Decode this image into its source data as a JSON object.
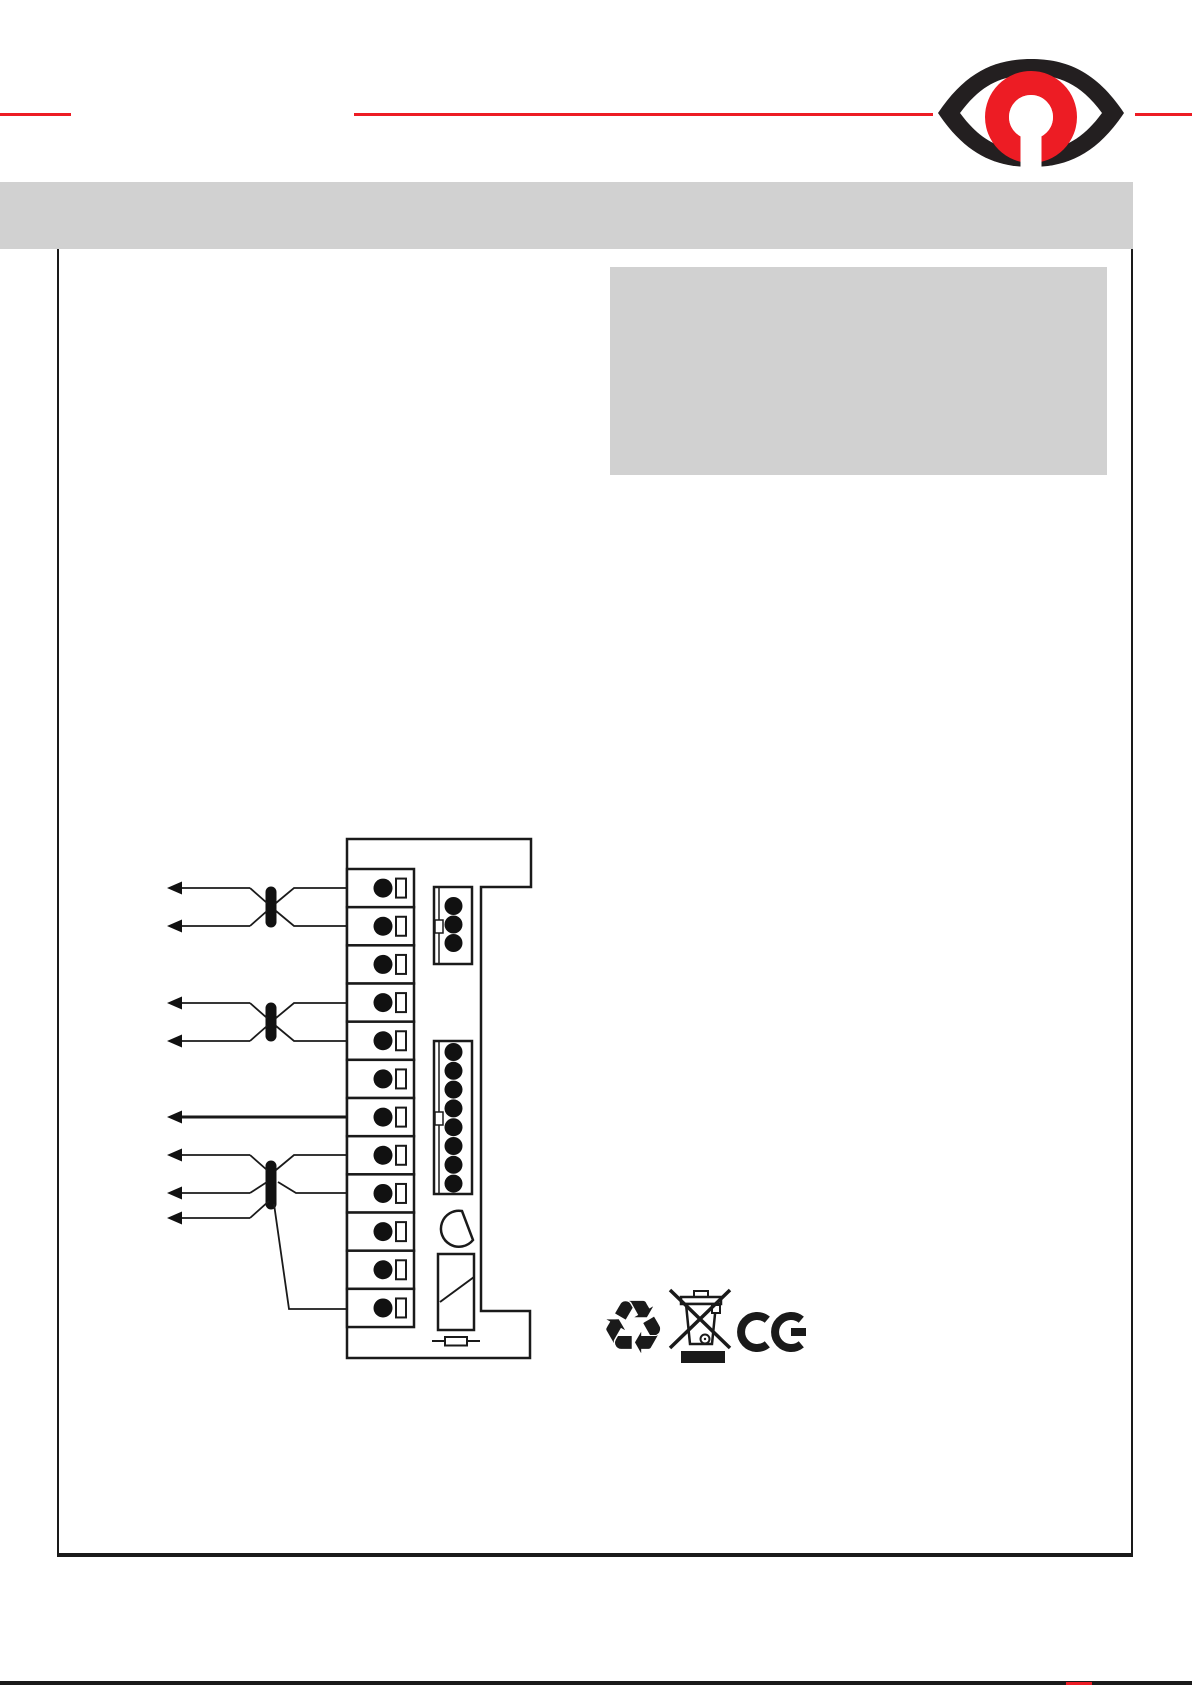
{
  "page": {
    "width": 1192,
    "height": 1685,
    "background": "#ffffff",
    "bottom_rule_color": "#1a1a1a"
  },
  "header": {
    "rule_color": "#ed1c24",
    "rule_segments": [
      [
        0,
        71
      ],
      [
        354,
        933
      ],
      [
        1135,
        1192
      ]
    ],
    "logo": {
      "name": "eye-keyhole-logo",
      "eye_color": "#231f20",
      "omega_color": "#ed1c24",
      "keyhole_color": "#ffffff"
    }
  },
  "title_bar": {
    "color": "#d1d1d1",
    "x": 0,
    "y": 182,
    "w": 1133,
    "h": 67
  },
  "content_box": {
    "x": 57,
    "y": 249,
    "w": 1076,
    "h": 1308
  },
  "info_panel": {
    "color": "#d1d1d1",
    "x": 610,
    "y": 267,
    "w": 497,
    "h": 208
  },
  "diagram": {
    "stroke_color": "#1a1a1a",
    "module_outline": "M347,839 H531 V887 H481 V1311 H530 V1358 H347 Z",
    "terminals": {
      "count": 12,
      "x": 347,
      "width": 67,
      "top": 869,
      "cell_height": 38.17,
      "circle_cx": 383,
      "circle_r": 9.5,
      "slot_x": 396,
      "slot_w": 10,
      "slot_h": 19
    },
    "connectors": [
      {
        "name": "3-pin-connector",
        "x": 434,
        "y": 887,
        "w": 38,
        "h": 77,
        "pins": 3,
        "pin_cx": 453.5,
        "pin_start": 19,
        "pin_step": 18.5,
        "pin_r": 9,
        "notch_dy": 33
      },
      {
        "name": "8-pin-connector",
        "x": 434,
        "y": 1041,
        "w": 38,
        "h": 153,
        "pins": 8,
        "pin_cx": 453.5,
        "pin_start": 11,
        "pin_step": 18.8,
        "pin_r": 9,
        "notch_dy": 71
      }
    ],
    "twists": [
      {
        "x": 271,
        "y1": 892,
        "y2": 922
      },
      {
        "x": 271,
        "y1": 1008,
        "y2": 1036
      },
      {
        "x": 271,
        "y1": 1166,
        "y2": 1204
      }
    ],
    "arrows": [
      {
        "y": 888,
        "tip_x": 167,
        "line_to": 250,
        "thick": false
      },
      {
        "y": 926,
        "tip_x": 167,
        "line_to": 250,
        "thick": false
      },
      {
        "y": 1003,
        "tip_x": 167,
        "line_to": 250,
        "thick": false
      },
      {
        "y": 1041,
        "tip_x": 167,
        "line_to": 250,
        "thick": false
      },
      {
        "y": 1117,
        "tip_x": 167,
        "line_to": 347,
        "thick": true
      },
      {
        "y": 1155,
        "tip_x": 167,
        "line_to": 250,
        "thick": false
      },
      {
        "y": 1193,
        "tip_x": 167,
        "line_to": 250,
        "thick": false
      },
      {
        "y": 1218,
        "tip_x": 167,
        "line_to": 250,
        "thick": false
      }
    ],
    "wire_paths": "M347,888 H294 L276,903 M347,926 H294 L276,911 M250,888 L267,903 M250,926 L267,911 M347,1003 H294 L276,1018 M347,1041 H294 L276,1026 M250,1003 L267,1018 M250,1041 L267,1026 M347,1155 H294 L276,1170 M347,1193 H296 L278,1182 M250,1155 L267,1170 M250,1193 L267,1182 M250,1218 L269,1201 M274,1204 L289,1309 H347",
    "dshape_path": "M462,1211 A18,18 0 1 0 473,1240 Z",
    "relay": {
      "x": 438,
      "y": 1254,
      "w": 36,
      "h": 76,
      "diagonal": "M440,1302 L474,1277"
    },
    "fuse": {
      "line": "M432,1341 H480",
      "x": 445,
      "y": 1337,
      "w": 22,
      "h": 8.5
    }
  },
  "footer_symbols": {
    "recycle_glyph": "♻",
    "weee": "crossed-out-wheelie-bin",
    "ce": "CE"
  }
}
